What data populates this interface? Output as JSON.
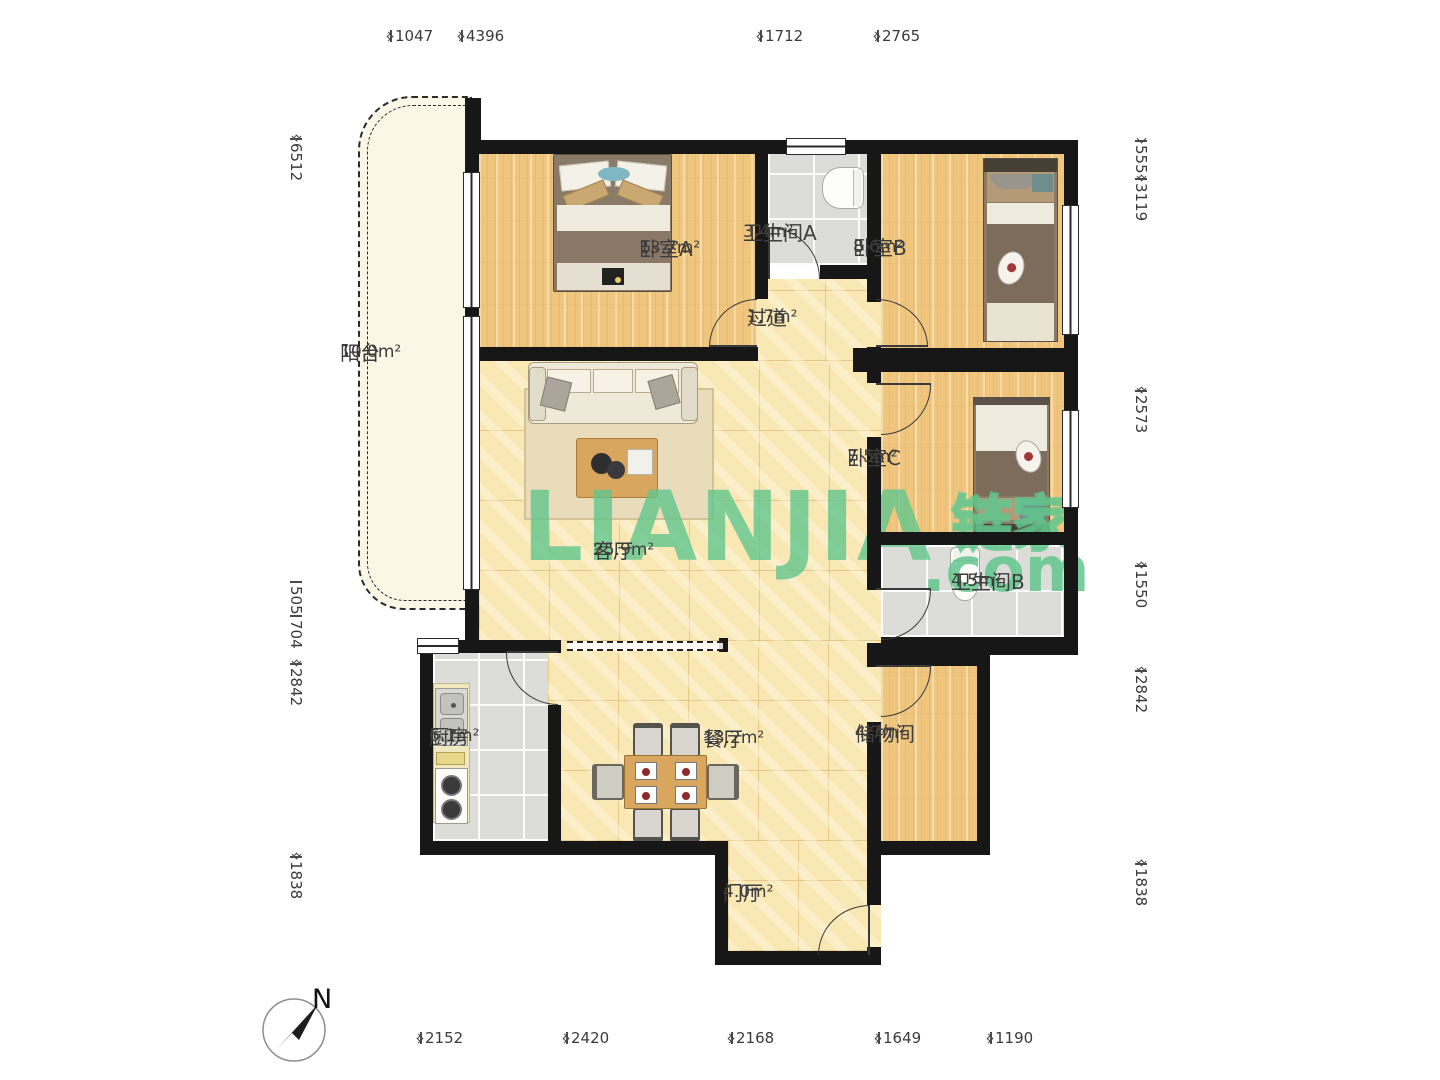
{
  "brand": {
    "watermark_latin": "LIANJIA",
    "watermark_cn": "链家",
    "watermark_domain": ".com"
  },
  "compass": {
    "north_label": "N"
  },
  "rooms": [
    {
      "name": "阳台",
      "area": "10.0m²"
    },
    {
      "name": "卧室A",
      "area": "13.7m²"
    },
    {
      "name": "卫生间A",
      "area": "3.4m²"
    },
    {
      "name": "卧室B",
      "area": "8.6m²"
    },
    {
      "name": "过道",
      "area": "1.7m²"
    },
    {
      "name": "卧室C",
      "area": "7.5m²"
    },
    {
      "name": "客厅",
      "area": "25.9m²"
    },
    {
      "name": "卫生间B",
      "area": "4.5m²"
    },
    {
      "name": "厨房",
      "area": "6.1m²"
    },
    {
      "name": "餐厅",
      "area": "13.2m²"
    },
    {
      "name": "储物间",
      "area": "4.7m²"
    },
    {
      "name": "门厅",
      "area": "4.0m²"
    }
  ],
  "dimensions_mm": {
    "top": [
      "1047",
      "4396",
      "1712",
      "2765"
    ],
    "bottom": [
      "2152",
      "2420",
      "2168",
      "1649",
      "1190"
    ],
    "left": [
      "6512",
      "505",
      "704",
      "2842",
      "1838"
    ],
    "right": [
      "555",
      "3119",
      "2573",
      "1550",
      "2842",
      "1838"
    ]
  },
  "colors": {
    "wall": "#171717",
    "wood_floor": "#f0c67e",
    "tile_floor": "#f9e7b4",
    "wet_floor": "#dcdcd8",
    "balcony_floor": "#faf7e6",
    "watermark_green": "#61c68d",
    "label_text": "#3d3d3d"
  }
}
